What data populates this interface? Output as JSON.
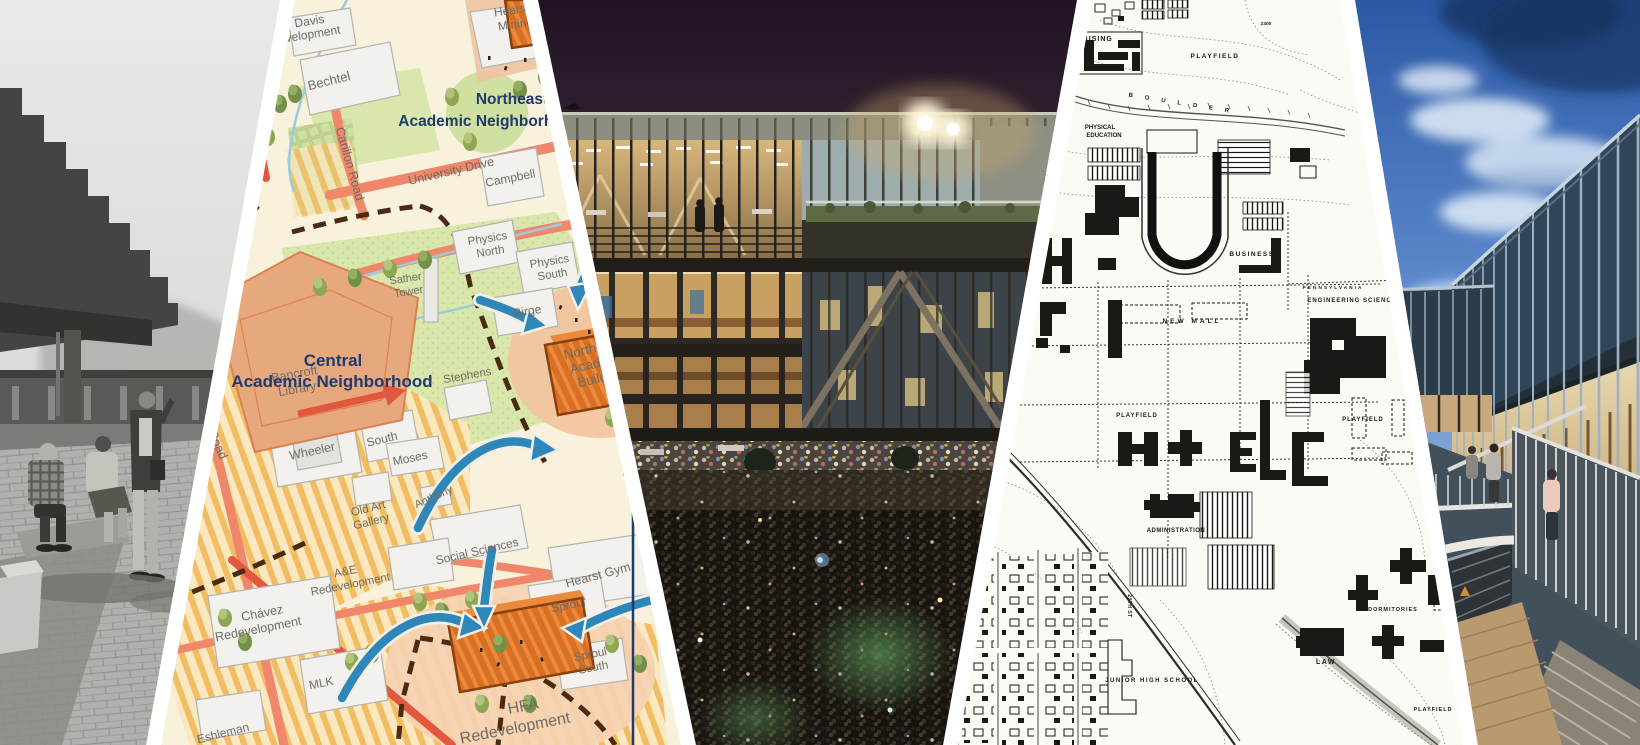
{
  "palette": {
    "divider": "#ffffff",
    "navy_label": "#1e3a6e",
    "map_label_gray": "#6f6b64",
    "map_bg": "#f8f1dc",
    "map_green": "#d9e7ac",
    "map_orange_building": "#d96f22",
    "road_salmon": "#f0876a",
    "road_red": "#e2573d",
    "arrow_blue": "#2f86b8",
    "path_dash_brown": "#4a2a10",
    "night_sky": "#241826",
    "historic_map_ink": "#1a1915",
    "dusk_sky_blue": "#3a67b0"
  },
  "plan_map": {
    "labels": {
      "davis_1": "Davis",
      "davis_2": "Development",
      "bechtel": "Bechtel",
      "hearst_mining_1": "Hearst",
      "hearst_mining_2": "Mining",
      "northeast_1": "Northeast",
      "northeast_2": "Academic Neighborhood",
      "carillon_road": "Carillon Road",
      "university_drive": "University Drive",
      "campbell": "Campbell",
      "physics_north_1": "Physics",
      "physics_north_2": "North",
      "physics_south_1": "Physics",
      "physics_south_2": "South",
      "sather_tower_1": "Sather",
      "sather_tower_2": "Tower",
      "birge": "Birge",
      "bancroft_1": "Bancroft",
      "bancroft_2": "Library",
      "central_1": "Central",
      "central_2": "Academic Neighborhood",
      "stephens": "Stephens",
      "wheeler": "Wheeler",
      "south_hall": "South",
      "moses": "Moses",
      "anthony": "Anthony",
      "old_art_1": "Old Art",
      "old_art_2": "Gallery",
      "social_sciences": "Social Sciences",
      "ae_1": "A&E",
      "ae_2": "Redevelopment",
      "sather_road": "Sather Road",
      "chavez_1": "Chávez",
      "chavez_2": "Redevelopment",
      "mlk": "MLK",
      "sproul": "Sproul",
      "sproul_south_1": "Sproul",
      "sproul_south_2": "South",
      "eshleman": "Eshleman",
      "north_field_1": "North Field",
      "north_field_2": "Academic",
      "north_field_3": "Building",
      "hearst_gym": "Hearst Gym",
      "hfa_1": "HFA",
      "hfa_2": "Redevelopment"
    }
  },
  "historic_map": {
    "labels": {
      "housing": "HOUSING",
      "playfield_top": "PLAYFIELD",
      "contour_2300": "2300",
      "physical_1": "PHYSICAL",
      "physical_2": "EDUCATION",
      "boulder": "BOULDER",
      "business": "BUSINESS",
      "pennsylvania": "PENNSYLVANIA",
      "engineering_science": "ENGINEERING SCIENCE",
      "new_mall": "NEW MALL",
      "playfield_left": "PLAYFIELD",
      "playfield_right": "PLAYFIELD",
      "administration": "ADMINISTRATION",
      "junior_high": "JUNIOR HIGH SCHOOL",
      "law": "LAW",
      "dormitories": "DORMITORIES",
      "playfield_bottom": "PLAYFIELD",
      "street_20th": "20TH ST"
    }
  }
}
